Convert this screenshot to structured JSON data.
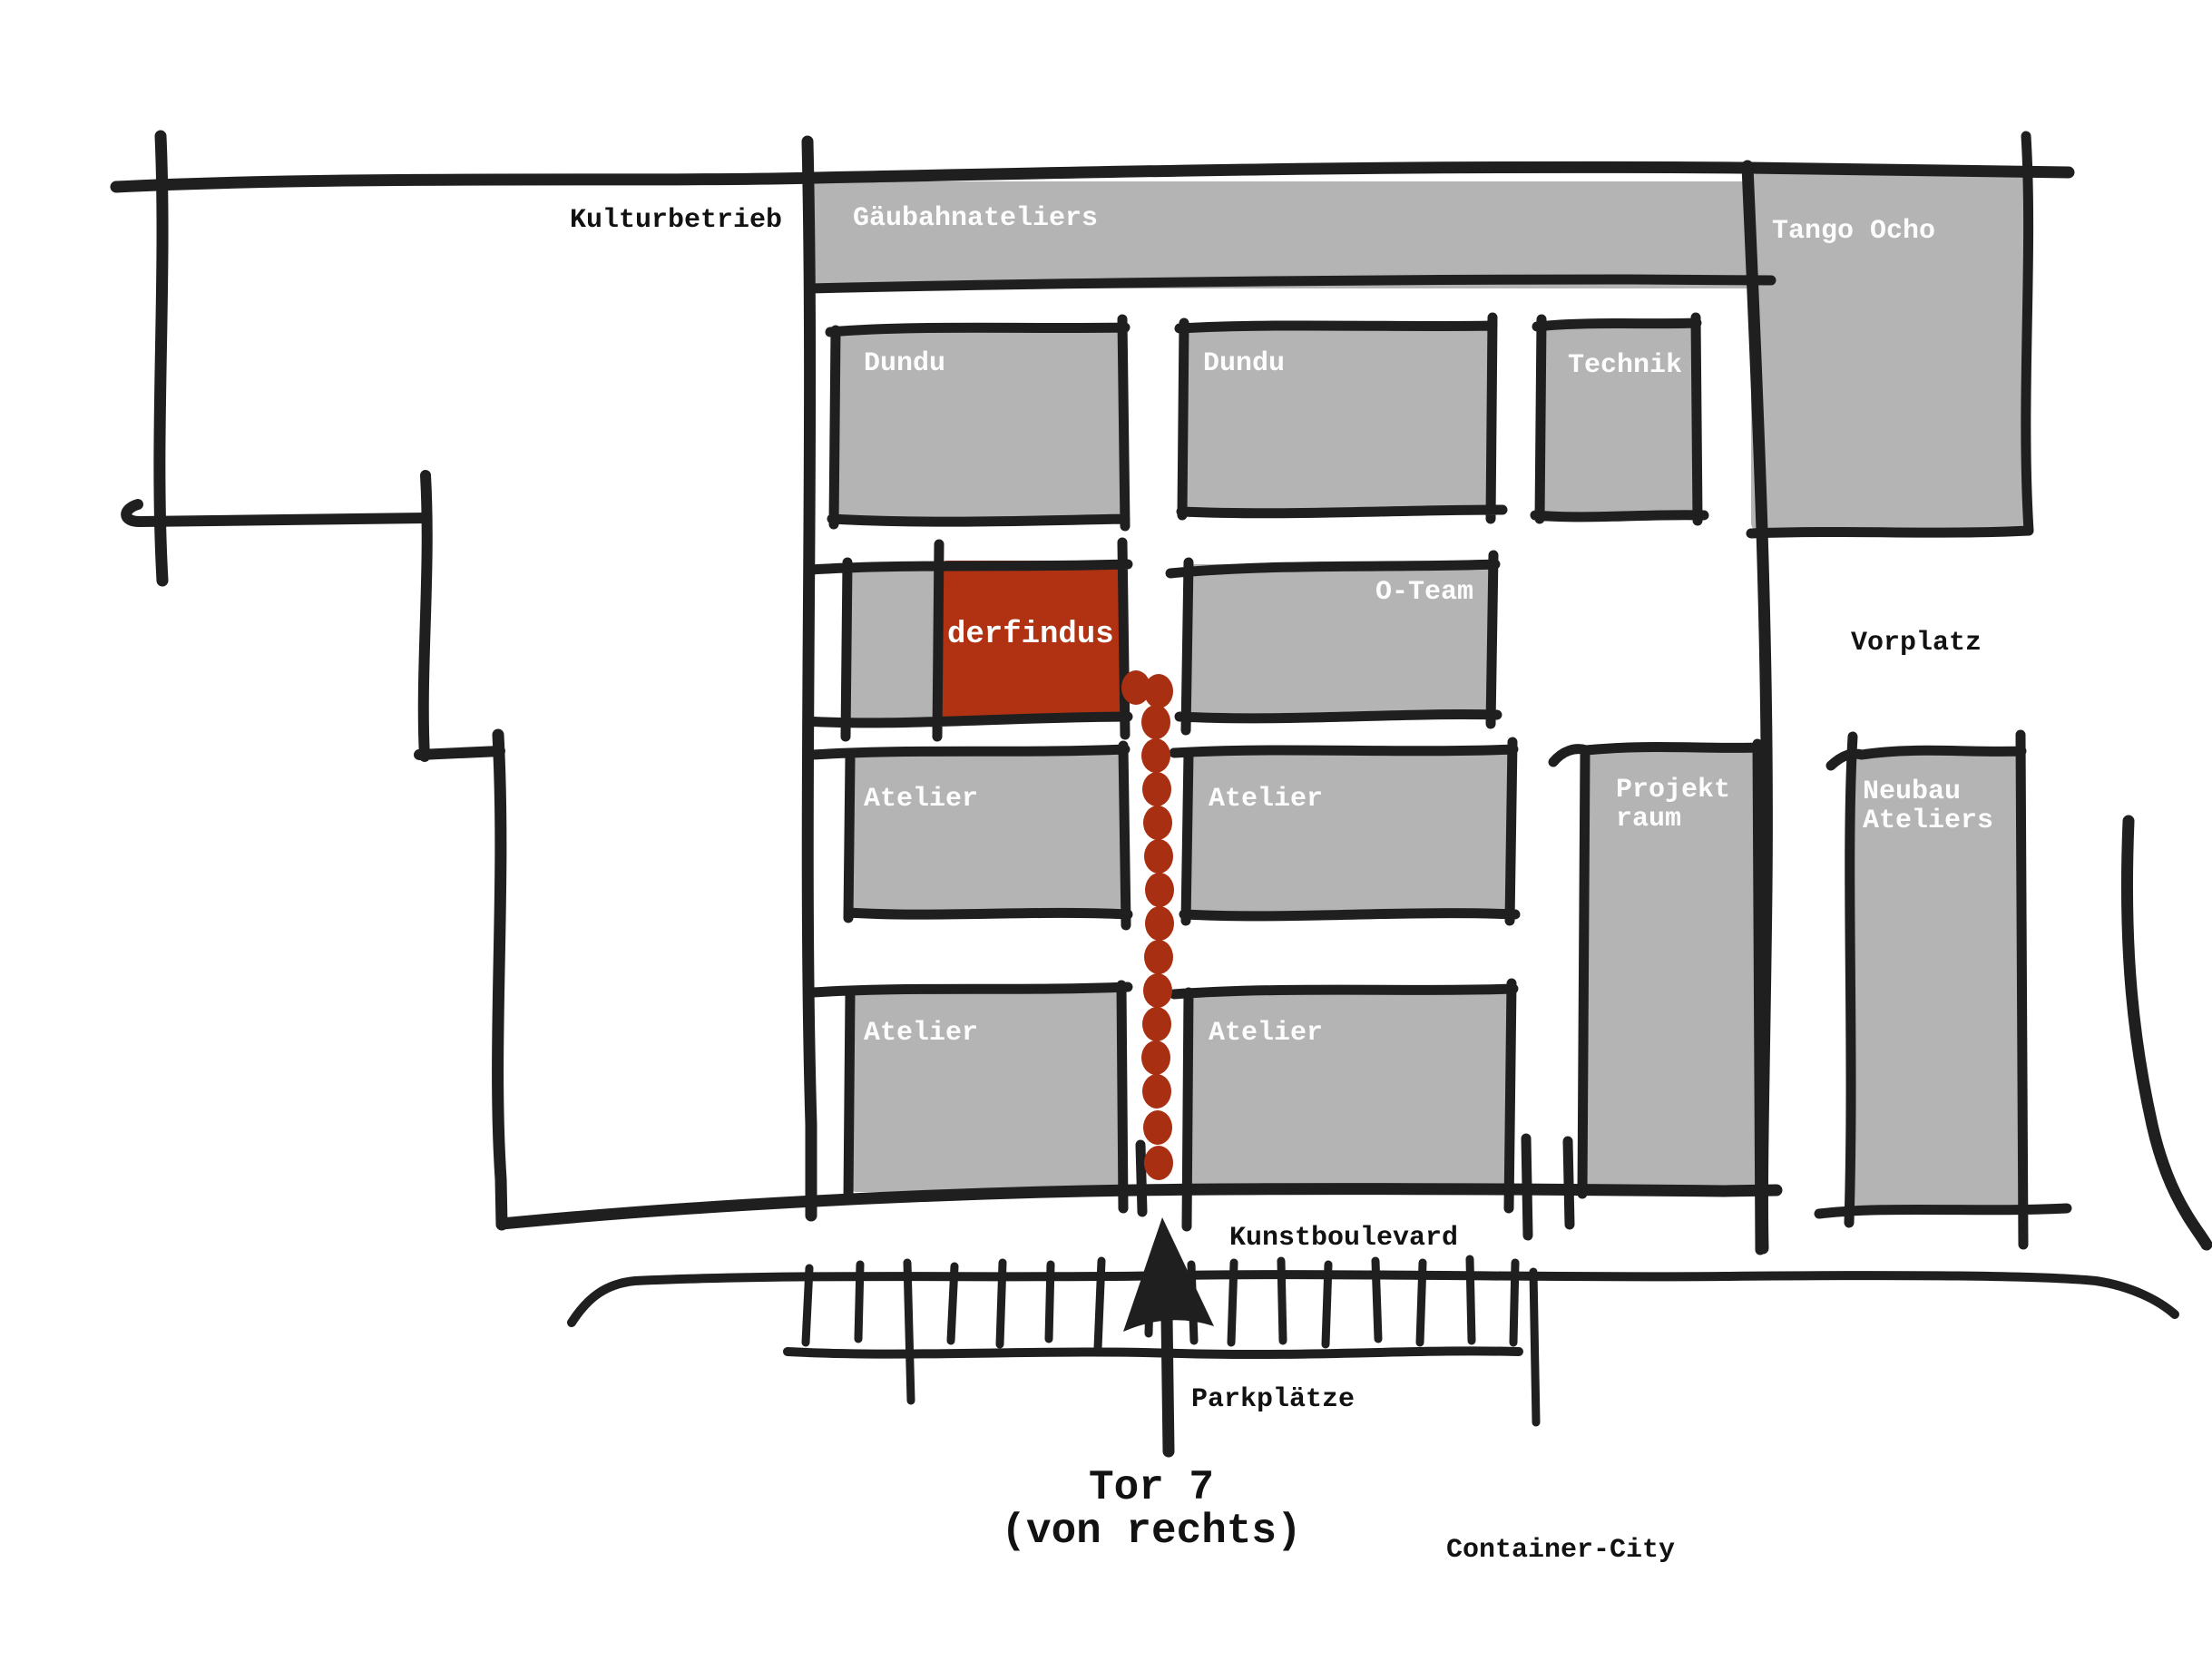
{
  "map": {
    "title_hint": "hand-drawn site plan",
    "colors": {
      "background": "#ffffff",
      "building_gray": "#b4b4b4",
      "accent_red": "#b13212",
      "dot_red": "#a82f12",
      "line_black": "#1f1f1f",
      "label_white": "#fdfdfd",
      "label_black": "#121212"
    },
    "labels": {
      "kulturbetrieb": "Kulturbetrieb",
      "gaeubahnateliers": "Gäubahnateliers",
      "tango_ocho": "Tango Ocho",
      "dundu_west": "Dundu",
      "dundu_east": "Dundu",
      "technik": "Technik",
      "derfindus": "derfindus",
      "o_team": "O-Team",
      "vorplatz": "Vorplatz",
      "atelier_nw": "Atelier",
      "atelier_ne": "Atelier",
      "atelier_sw": "Atelier",
      "atelier_se": "Atelier",
      "projektraum_line1": "Projekt",
      "projektraum_line2": "raum",
      "neubau_line1": "Neubau",
      "neubau_line2": "Ateliers",
      "kunstboulevard": "Kunstboulevard",
      "parkplaetze": "Parkplätze",
      "tor7_line1": "Tor 7",
      "tor7_line2": "(von rechts)",
      "container_city": "Container-City"
    }
  }
}
